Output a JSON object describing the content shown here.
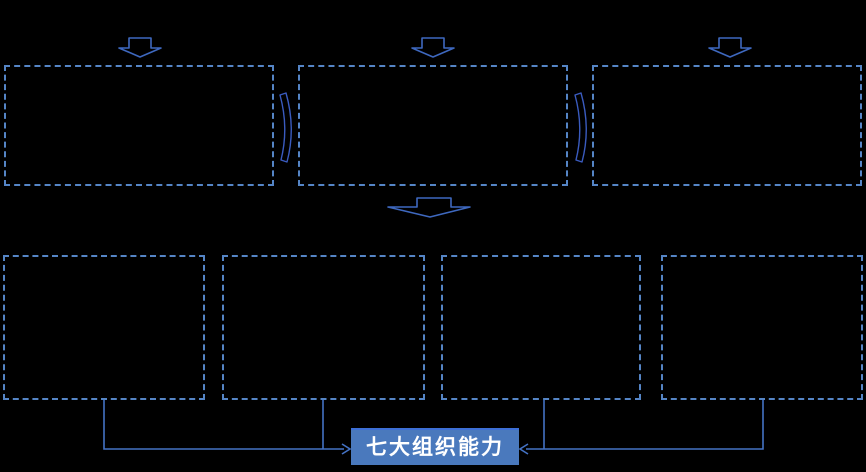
{
  "diagram": {
    "background_color": "#000000",
    "top_row": {
      "box_count": 3,
      "boxes_have_visible_text": false
    },
    "bottom_row": {
      "box_count": 4,
      "boxes_have_visible_text": false
    },
    "button": {
      "label": "七大组织能力"
    },
    "colors": {
      "box_border": "#5585C6",
      "small_arrow_stroke": "#3E68BF",
      "chevron_stroke": "#3A5BBF",
      "connector_stroke": "#4472C4",
      "button_fill": "#4A79BD",
      "button_top_edge": "#3D6FD6",
      "button_text": "#FFFFFF"
    }
  }
}
